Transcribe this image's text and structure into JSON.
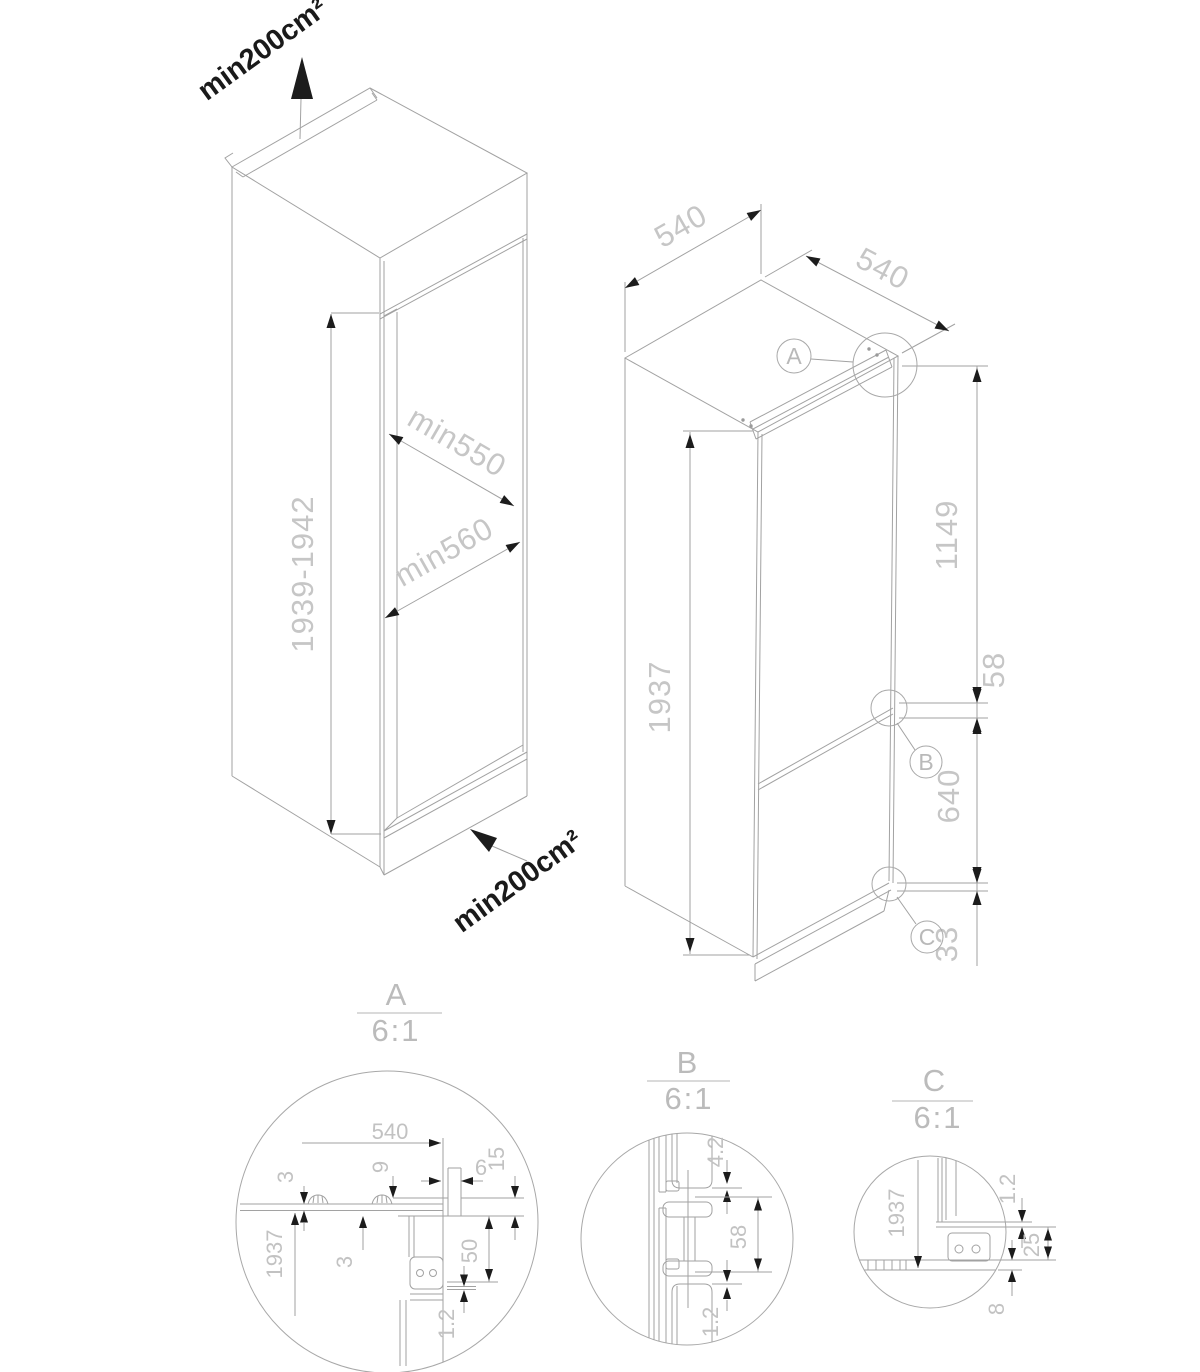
{
  "figure_cabinet": {
    "vent_top": "min200cm²",
    "vent_bottom": "min200cm²",
    "niche_height": "1939-1942",
    "niche_depth_min": "min550",
    "niche_depth_door": "min560"
  },
  "figure_fridge": {
    "depth": "540",
    "width": "540",
    "height": "1937",
    "dim_upper": "1149",
    "dim_hinge": "58",
    "dim_lower": "640",
    "dim_bottom": "33",
    "callout_a": "A",
    "callout_b": "B",
    "callout_c": "C"
  },
  "detail_a": {
    "label": "A",
    "scale": "6:1",
    "dim_depth": "540",
    "dim_panel": "3",
    "dim_height": "1937",
    "dim_rail": "9",
    "dim_gap": "3",
    "dim_front": "6",
    "dim_overlap": "15",
    "dim_hinge": "50",
    "dim_liner": "1.2"
  },
  "detail_b": {
    "label": "B",
    "scale": "6:1",
    "dim_top_gap": "4.2",
    "dim_hinge": "58",
    "dim_bottom_gap": "1.2"
  },
  "detail_c": {
    "label": "C",
    "scale": "6:1",
    "dim_height": "1937",
    "dim_door_gap": "1.2",
    "dim_overlap": "25",
    "dim_floor": "8"
  }
}
